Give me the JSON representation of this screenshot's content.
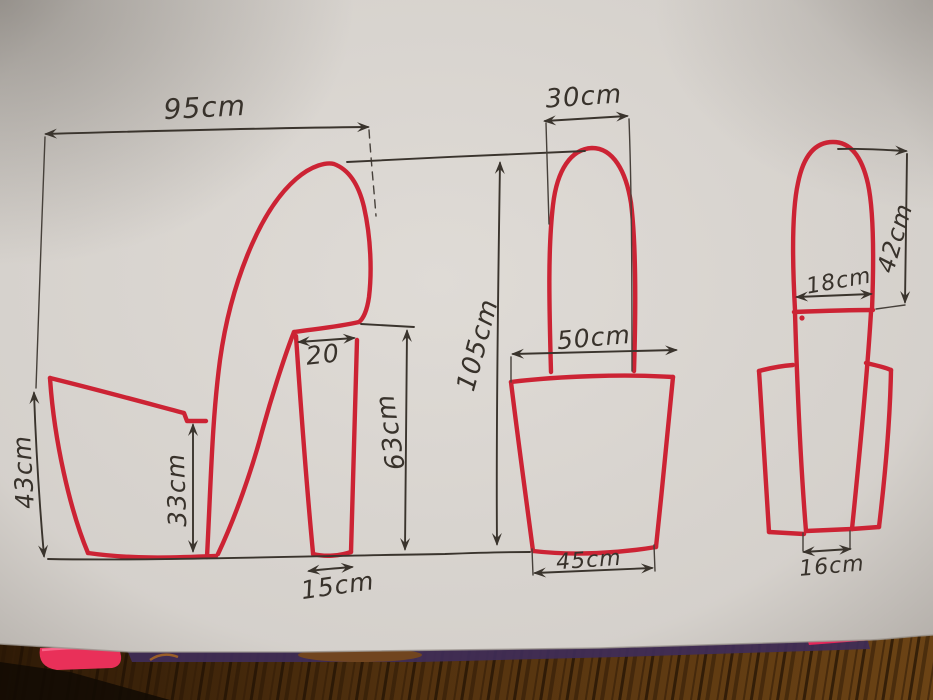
{
  "colors": {
    "marker_red": "#cc2334",
    "pen_black": "#3a342d",
    "paper": "#dfdbd6",
    "wood_dark": "#3a2008",
    "wood_light": "#7a4a16",
    "pink_object": "#e93059",
    "purple_edge": "#3f2c58",
    "pink_edge_right": "#e5265a"
  },
  "sketch": {
    "side_view": {
      "overall_width": "95cm",
      "front_height": "43cm",
      "mid_height": "33cm",
      "heel_top_width": "20",
      "heel_height": "63cm",
      "heel_base_width": "15cm"
    },
    "front_view": {
      "top_width": "30cm",
      "overall_height": "105cm",
      "body_top_width": "50cm",
      "body_base_width": "45cm"
    },
    "back_view": {
      "column_height": "42cm",
      "column_width": "18cm",
      "base_width": "16cm"
    }
  }
}
